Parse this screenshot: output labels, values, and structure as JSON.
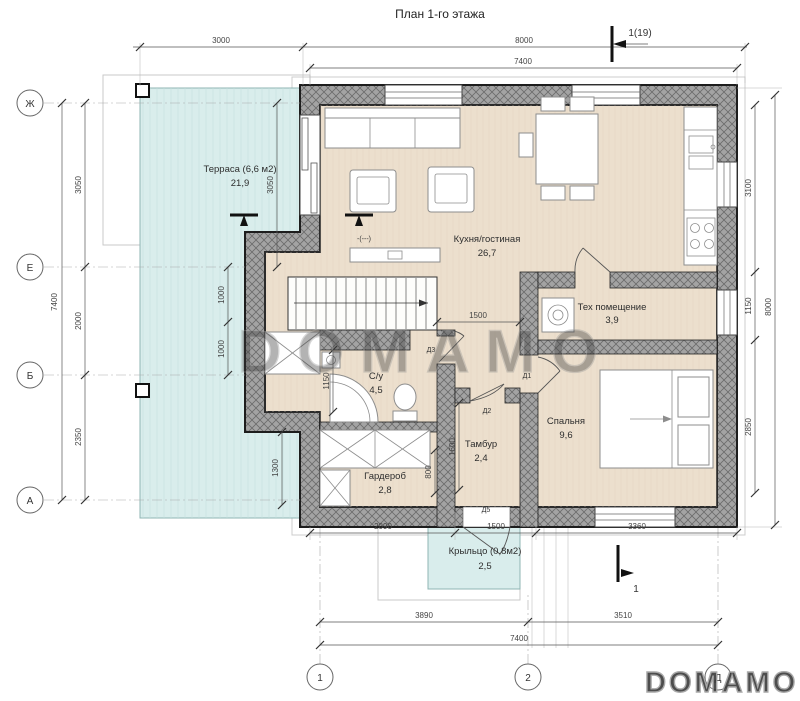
{
  "title": "План 1-го этажа",
  "watermark": {
    "large": "DOMAMO",
    "corner": "DOMAMO"
  },
  "sections": {
    "top": "1(19)",
    "bottom": "1"
  },
  "level_mark": "-(---)",
  "axes": {
    "left": [
      "Ж",
      "Е",
      "Б",
      "А"
    ],
    "bottom": [
      "1",
      "2",
      "Д"
    ]
  },
  "rooms": {
    "terrace": {
      "name": "Терраса (6,6 м2)",
      "area": "21,9"
    },
    "kitchen": {
      "name": "Кухня/гостиная",
      "area": "26,7"
    },
    "tech": {
      "name": "Тех помещение",
      "area": "3,9"
    },
    "bedroom": {
      "name": "Спальня",
      "area": "9,6"
    },
    "bathroom": {
      "name": "С/у",
      "area": "4,5"
    },
    "tambour": {
      "name": "Тамбур",
      "area": "2,4"
    },
    "wardrobe": {
      "name": "Гардероб",
      "area": "2,8"
    },
    "porch": {
      "name": "Крыльцо (0,8м2)",
      "area": "2,5"
    }
  },
  "doors": {
    "d1": "Д1",
    "d2": "Д2",
    "d3": "Д3",
    "d5": "Д5"
  },
  "dims": {
    "top_3000": "3000",
    "top_8000": "8000",
    "top_7400": "7400",
    "left_7400": "7400",
    "left_3050": "3050",
    "left_2000": "2000",
    "left_2350": "2350",
    "inner_1000a": "1000",
    "inner_1000b": "1000",
    "inner_3050": "3050",
    "inner_1300": "1300",
    "right_3100": "3100",
    "right_1150": "1150",
    "right_2850": "2850",
    "right_8000": "8000",
    "bottom_2090": "2090",
    "bottom_1500": "1500",
    "bottom_3360": "3360",
    "bottom_3890": "3890",
    "bottom_3510": "3510",
    "bottom_7400": "7400",
    "hall_1500": "1500",
    "su_1150": "1150",
    "tamb_1600": "1600",
    "tamb_800": "800"
  },
  "colors": {
    "terrace": "#d9edec",
    "floor": "#ecdfcd",
    "wall": "#a3a3a3"
  }
}
